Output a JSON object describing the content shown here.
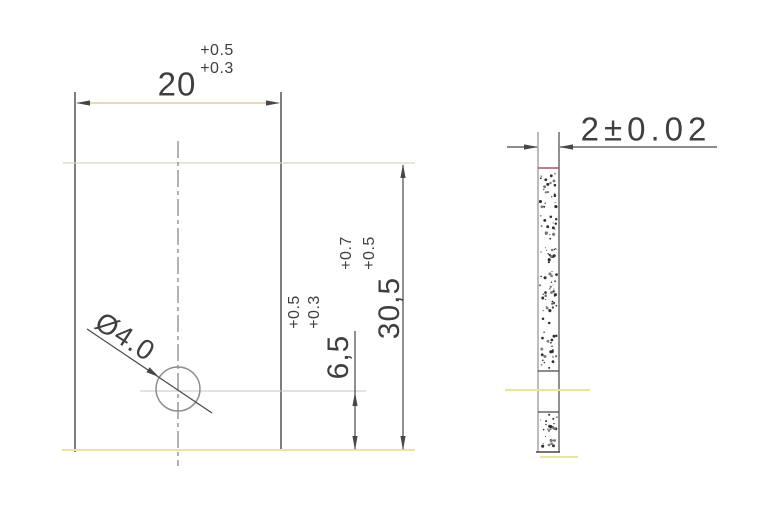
{
  "drawing": {
    "front_view": {
      "width_dim": {
        "value": "20",
        "tol_upper": "+0.5",
        "tol_lower": "+0.3"
      },
      "height_dim": {
        "value": "30,5",
        "tol_upper": "+0.7",
        "tol_lower": "+0.5"
      },
      "hole_offset_dim": {
        "value": "6,5",
        "tol_upper": "+0.5",
        "tol_lower": "+0.3"
      },
      "hole_diameter_label": "Ø4.0"
    },
    "side_view": {
      "thickness_dim": {
        "value": "2±0.02"
      }
    }
  },
  "colors": {
    "background": "#ffffff",
    "text": "#3f3f3f",
    "line-dark": "#474747",
    "line-medium": "#8f8f8f",
    "dim-line-tan": "#d9c488",
    "edge-faint-yellow": "#ede39b",
    "edge-faint-grey": "#d9d4bd",
    "accent-maroon": "#a4566a"
  }
}
